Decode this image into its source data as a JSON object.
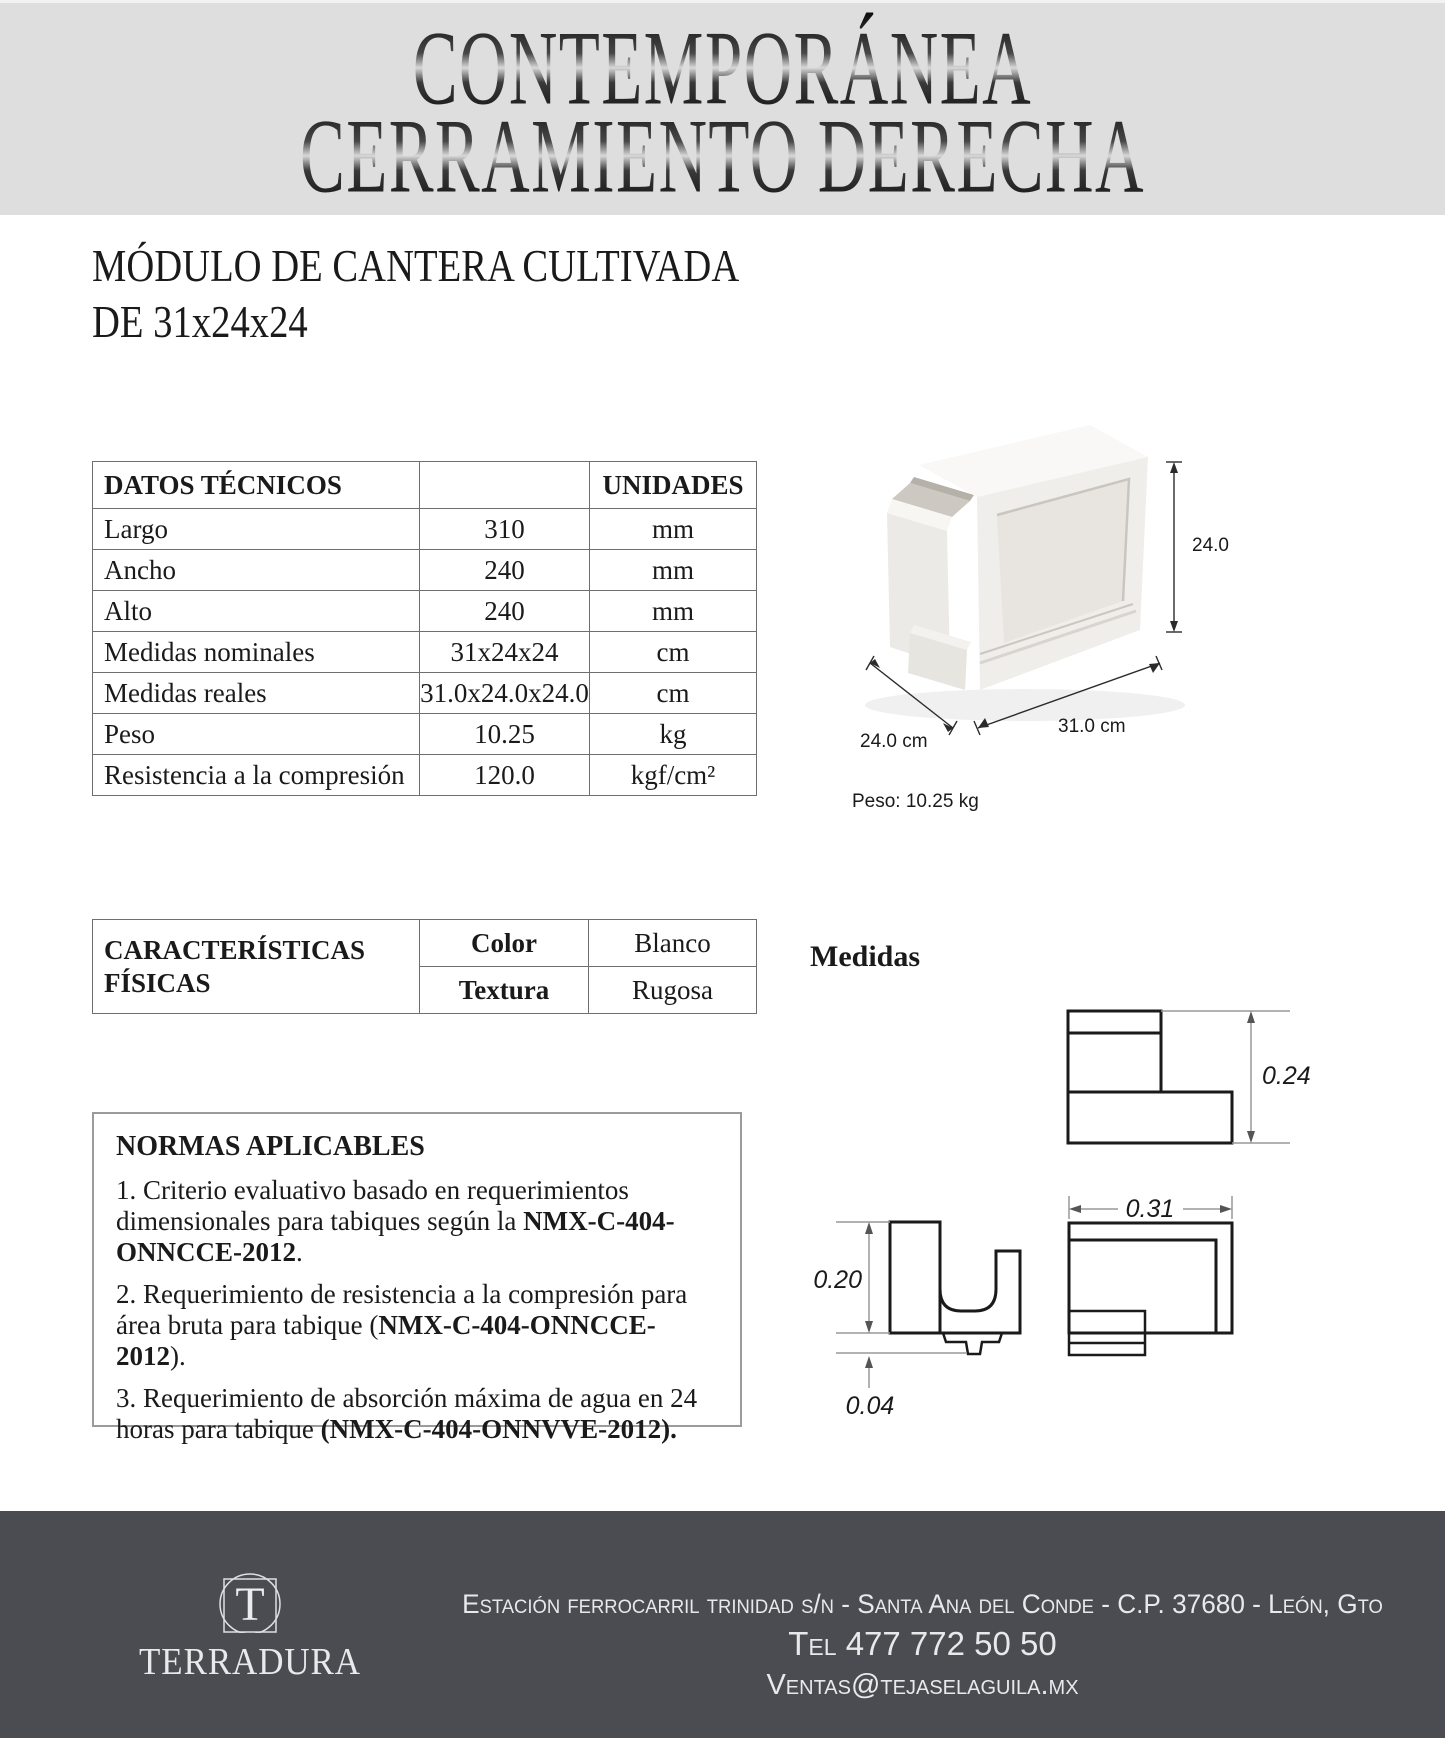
{
  "banner": {
    "title_line1": "CONTEMPORÁNEA",
    "title_line2": "CERRAMIENTO DERECHA"
  },
  "subtitle": {
    "line1": "MÓDULO DE CANTERA CULTIVADA",
    "line2": "DE 31x24x24"
  },
  "technical_table": {
    "header": {
      "col1": "DATOS TÉCNICOS",
      "col2": "",
      "col3": "UNIDADES"
    },
    "rows": [
      {
        "label": "Largo",
        "value": "310",
        "unit": "mm"
      },
      {
        "label": "Ancho",
        "value": "240",
        "unit": "mm"
      },
      {
        "label": "Alto",
        "value": "240",
        "unit": "mm"
      },
      {
        "label": "Medidas nominales",
        "value": "31x24x24",
        "unit": "cm"
      },
      {
        "label": "Medidas reales",
        "value": "31.0x24.0x24.0",
        "unit": "cm"
      },
      {
        "label": "Peso",
        "value": "10.25",
        "unit": "kg"
      },
      {
        "label": "Resistencia a la compresión",
        "value": "120.0",
        "unit": "kgf/cm²"
      }
    ]
  },
  "product_figure": {
    "dim_height": "24.0 cm",
    "dim_length": "31.0 cm",
    "dim_depth": "24.0 cm",
    "weight_caption": "Peso: 10.25 kg"
  },
  "physical_table": {
    "title": "CARACTERÍSTICAS FÍSICAS",
    "rows": [
      {
        "label": "Color",
        "value": "Blanco"
      },
      {
        "label": "Textura",
        "value": "Rugosa"
      }
    ]
  },
  "medidas": {
    "heading": "Medidas",
    "dims": {
      "height": "0.24",
      "profile_height": "0.20",
      "lip": "0.04",
      "length": "0.31"
    }
  },
  "normas": {
    "heading": "NORMAS APLICABLES",
    "items": [
      {
        "prefix": "1. Criterio evaluativo basado en requerimientos dimensionales para tabiques según la ",
        "bold": "NMX-C-404-ONNCCE-2012",
        "suffix": "."
      },
      {
        "prefix": "2. Requerimiento de resistencia a la compresión para área bruta para tabique (",
        "bold": "NMX-C-404-ONNCCE-2012",
        "suffix": ")."
      },
      {
        "prefix": "3. Requerimiento de absorción máxima de agua en 24 horas para tabique ",
        "bold": "(NMX-C-404-ONNVVE-2012).",
        "suffix": ""
      }
    ]
  },
  "footer": {
    "logo_letter": "T",
    "brand": "TERRADURA",
    "address": "Estación ferrocarril trinidad s/n - Santa Ana del Conde - C.P. 37680 - León, Gto",
    "phone": "Tel 477 772 50 50",
    "email": "Ventas@tejaselaguila.mx"
  },
  "colors": {
    "banner_bg": "#dedede",
    "footer_bg": "#4b4b52",
    "text": "#1a1a1a",
    "table_line": "#6f6f6f",
    "block_white": "#f0eeea"
  }
}
